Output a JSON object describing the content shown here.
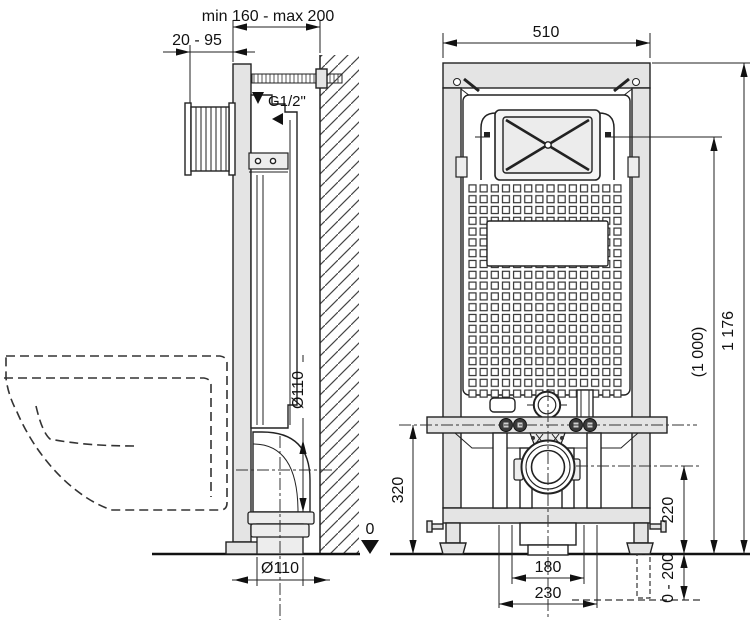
{
  "drawing": {
    "side_view": {
      "dim_wall_distance": "min 160 - max 200",
      "dim_actuator_depth": "20 - 95",
      "water_connection_label": "G1/2\"",
      "dim_elbow_diameter": "Ø110",
      "dim_outlet_diameter": "Ø110",
      "datum_label": "0"
    },
    "front_view": {
      "dim_frame_width": "510",
      "dim_frame_height": "1 176",
      "dim_flush_plate_height": "(1 000)",
      "dim_fixing_height": "320",
      "dim_outlet_height": "220",
      "dim_foot_adjust_range": "0 - 200",
      "dim_bolt_spacing": "180",
      "dim_outlet_spacing": "230"
    },
    "colors": {
      "line": "#222222",
      "metal_fill": "#e4e4e4",
      "background": "#ffffff"
    }
  }
}
